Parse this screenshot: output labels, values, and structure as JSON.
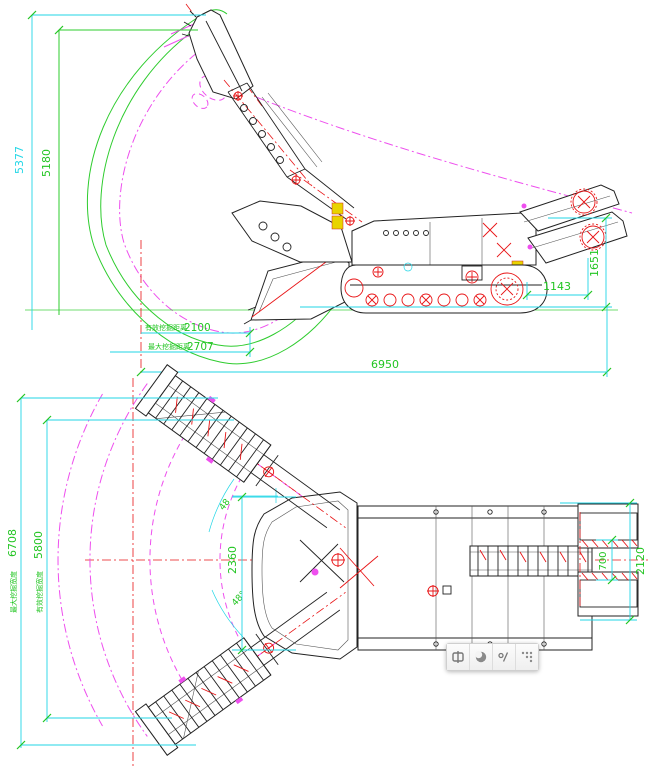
{
  "drawing": {
    "side_view": {
      "dim_height_max": "5377",
      "dim_height_effective": "5180",
      "reach_effective": {
        "label": "有效挖掘距离",
        "value": "2100"
      },
      "reach_max": {
        "label": "最大挖掘距离",
        "value": "2707"
      },
      "dim_overall_length": "6950",
      "dim_rear_height": "1651",
      "dim_rear_length": "1143"
    },
    "top_view": {
      "width_max": {
        "label": "最大挖掘宽度",
        "value": "6708"
      },
      "width_effective": {
        "label": "有效挖掘宽度",
        "value": "5800"
      },
      "dim_bucket_width": "2360",
      "swing_angle_upper": "48",
      "swing_angle_lower": "48°",
      "dim_rear_width": "700",
      "dim_overall_width": "2120"
    },
    "colors": {
      "dimension_line": "#21d6e6",
      "dimension_text": "#22c522",
      "envelope_green": "#2ecc2e",
      "envelope_magenta": "#ee4fee",
      "centerline_red": "#e81416",
      "outline_black": "#222222",
      "highlight_yellow": "#e8d400"
    }
  },
  "toolbar": {
    "buttons": [
      {
        "icon": "rect-split-icon"
      },
      {
        "icon": "moon-icon"
      },
      {
        "icon": "degree-slash-icon"
      },
      {
        "icon": "dots-grid-icon"
      }
    ]
  }
}
